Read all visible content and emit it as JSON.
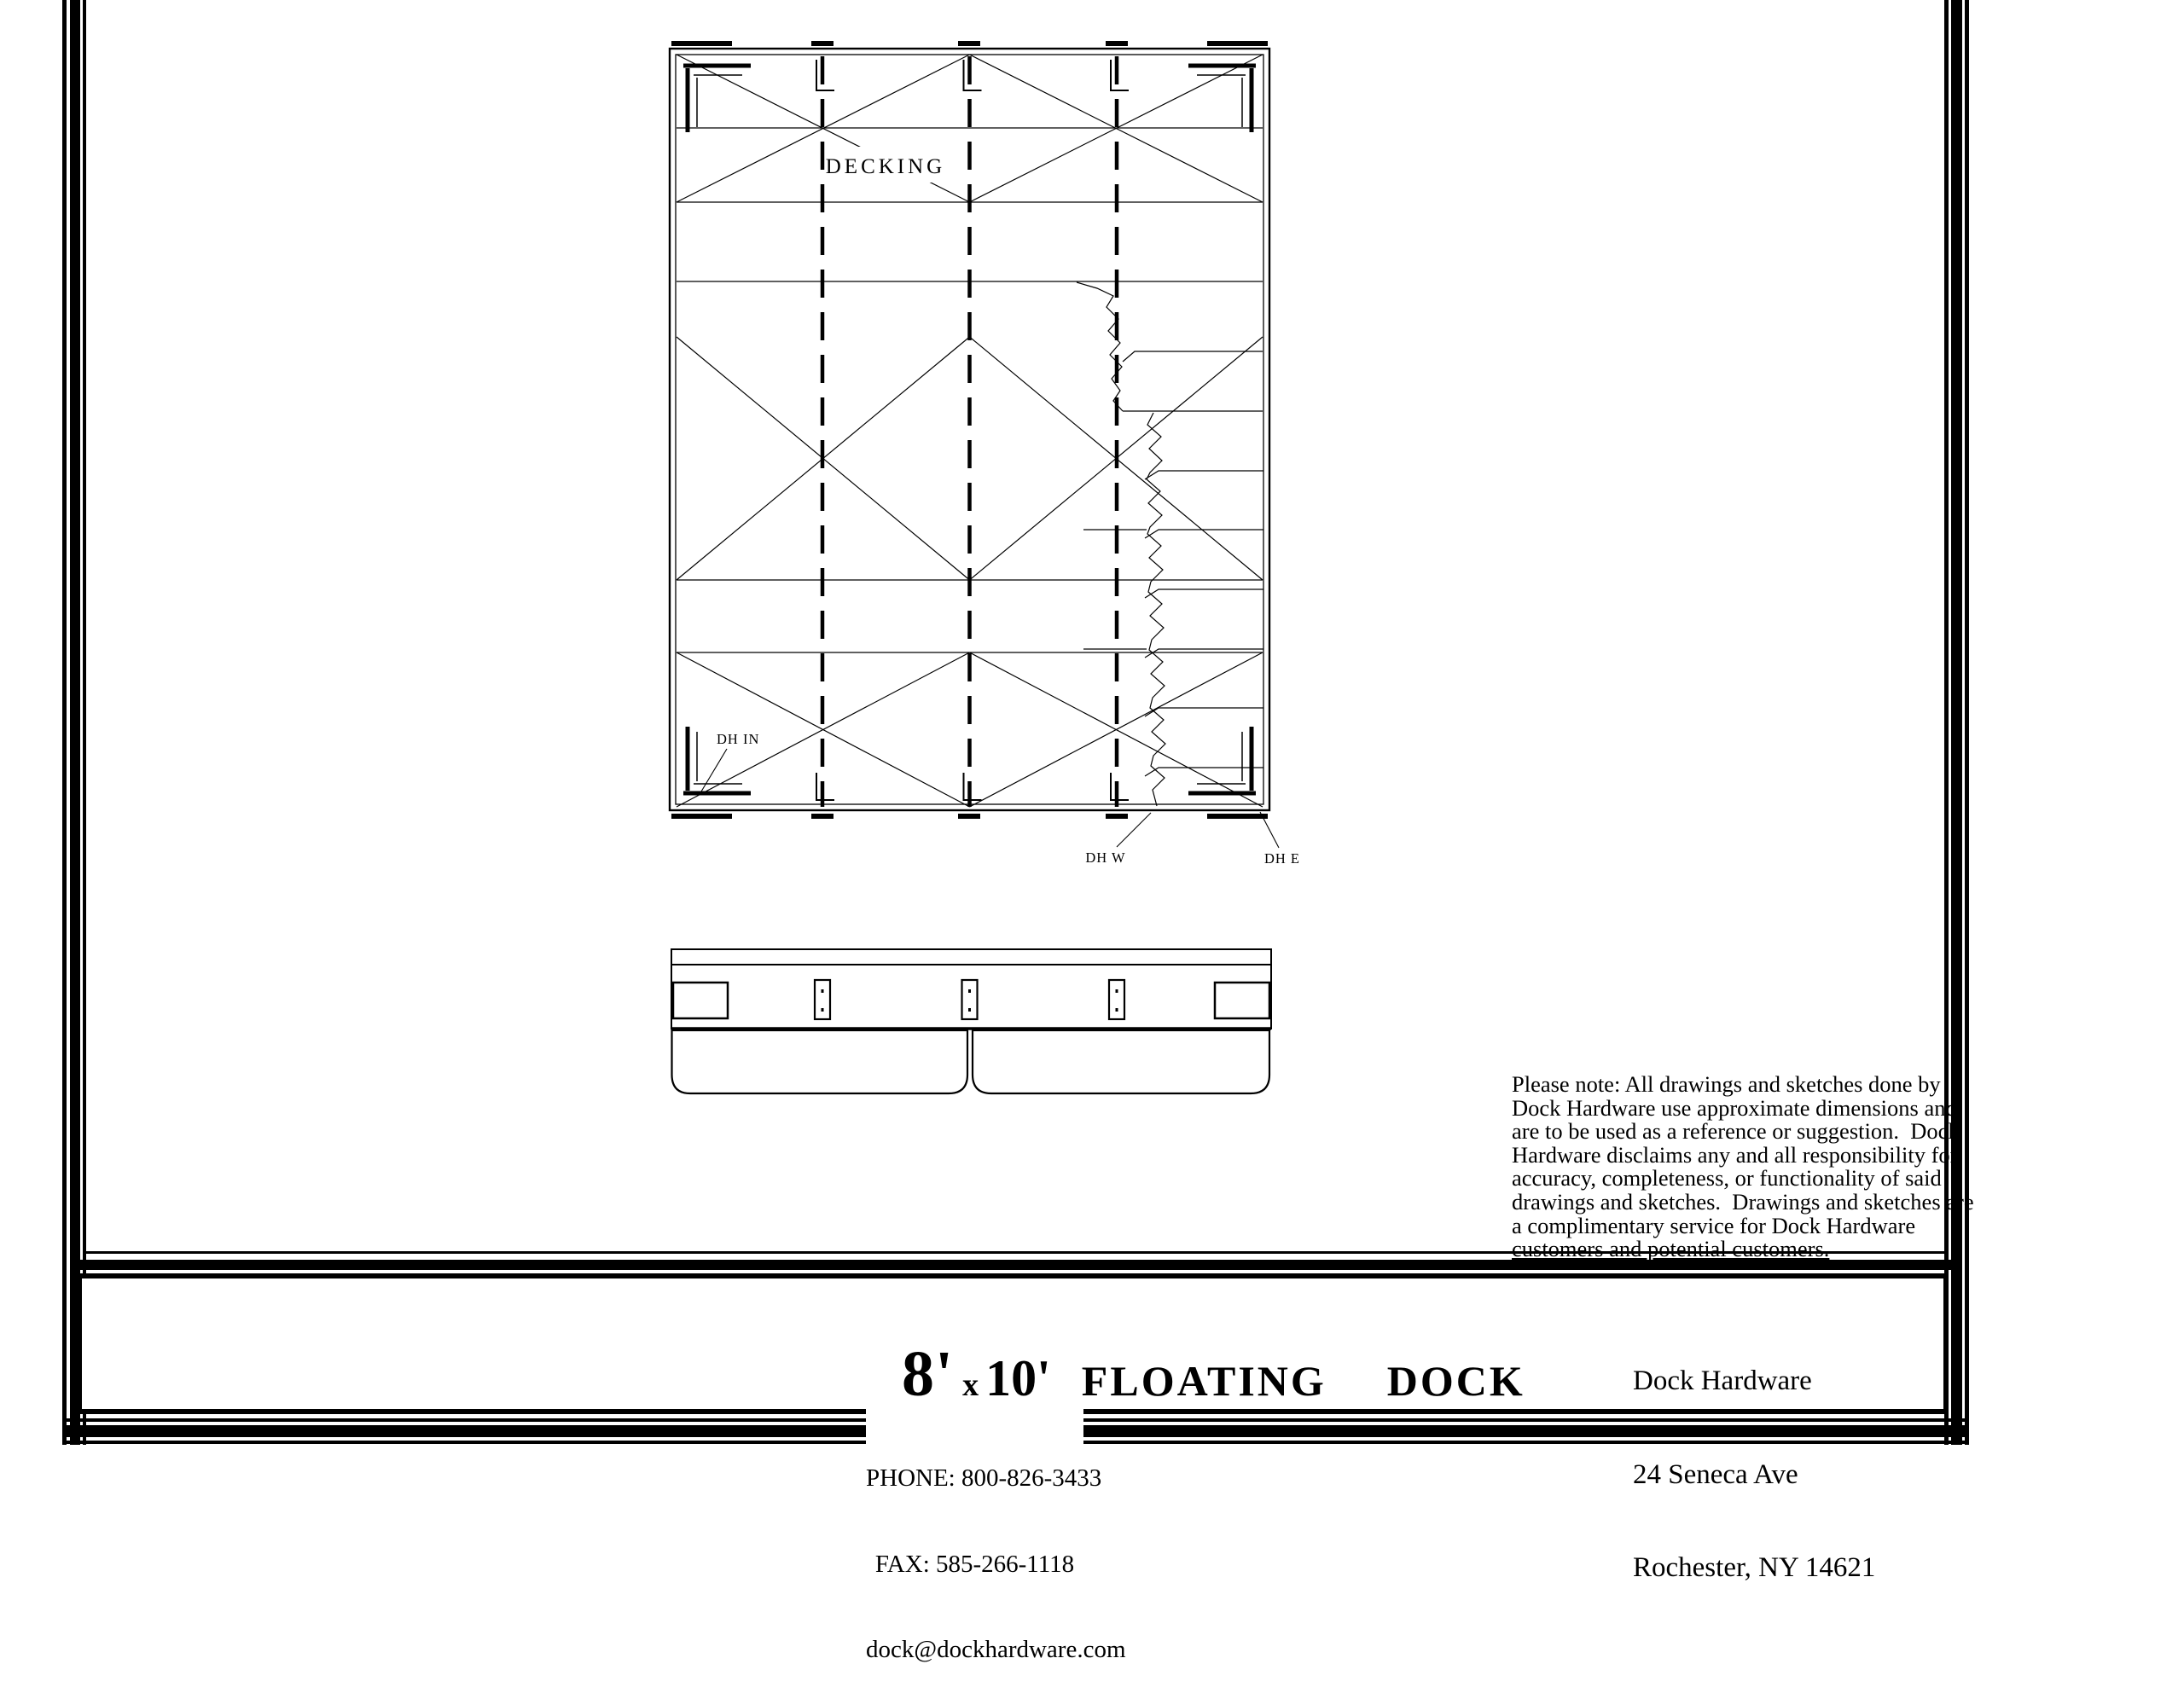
{
  "plan_view": {
    "decking_label": "DECKING",
    "hardware_labels": {
      "dh_in": "DH IN",
      "dh_w": "DH W",
      "dh_e": "DH E"
    }
  },
  "disclaimer": {
    "lines": [
      "Please note: All drawings and sketches done by",
      "Dock Hardware use approximate dimensions and",
      "are to be used as a reference or suggestion.  Dock",
      "Hardware disclaims any and all responsibility for",
      "accuracy, completeness, or functionality of said",
      "drawings and sketches.  Drawings and sketches are",
      "a complimentary service for Dock Hardware",
      "customers and potential customers."
    ]
  },
  "title_block": {
    "size_primary": "8'",
    "times_symbol": "x",
    "size_secondary": "10'",
    "product_title": "FLOATING  DOCK",
    "company_name": "Dock Hardware",
    "company_address1": "24 Seneca Ave",
    "company_address2": "Rochester, NY 14621"
  },
  "footer_contact": {
    "phone": "PHONE: 800-826-3433",
    "fax": "FAX: 585-266-1118",
    "email": "dock@dockhardware.com"
  },
  "colors": {
    "ink": "#000000",
    "paper": "#ffffff"
  }
}
